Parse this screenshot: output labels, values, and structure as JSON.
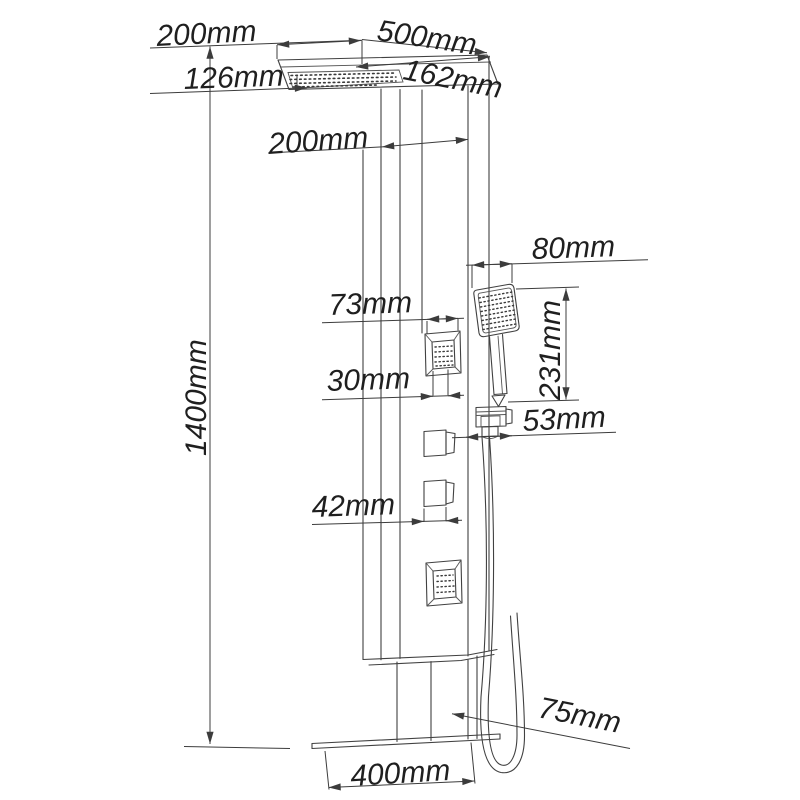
{
  "diagram": {
    "type": "technical-drawing",
    "subject": "shower panel dimensional diagram",
    "unit": "mm",
    "background": "#ffffff",
    "line_color": "#414141",
    "text_color": "#1f1f1f"
  },
  "dimensions": {
    "head_depth": {
      "label": "200mm"
    },
    "head_width": {
      "label": "500mm"
    },
    "head_offset": {
      "label": "126mm"
    },
    "head_side": {
      "label": "162mm"
    },
    "panel_width": {
      "label": "200mm"
    },
    "hand_shower_width": {
      "label": "80mm"
    },
    "jet_width": {
      "label": "73mm"
    },
    "hand_shower_height": {
      "label": "231mm"
    },
    "jet_inner_width": {
      "label": "30mm"
    },
    "holder_offset": {
      "label": "53mm"
    },
    "knob_width": {
      "label": "42mm"
    },
    "total_height": {
      "label": "1400mm"
    },
    "spout_length": {
      "label": "75mm"
    },
    "base_width": {
      "label": "400mm"
    }
  }
}
